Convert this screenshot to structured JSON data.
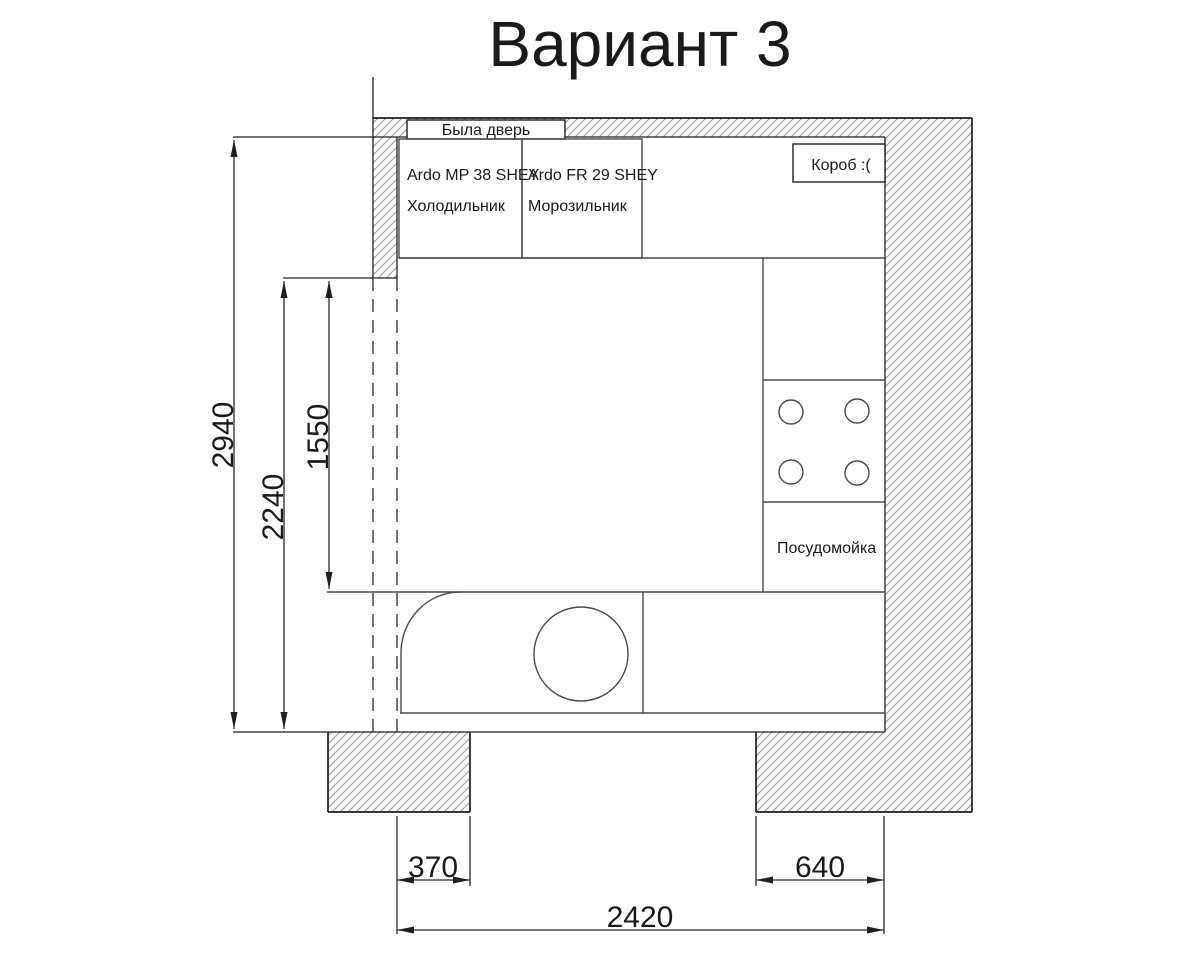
{
  "title": "Вариант 3",
  "plan": {
    "former_door_label": "Была дверь",
    "appliances": {
      "fridge_model": "Ardo MP 38 SHEY",
      "fridge_name": "Холодильник",
      "freezer_model": "Ardo FR 29 SHEY",
      "freezer_name": "Морозильник",
      "duct_label": "Короб :(",
      "dishwasher_label": "Посудомойка"
    },
    "dimensions_mm": {
      "room_depth": "2940",
      "opening_depth": "2240",
      "free_wall_length": "1550",
      "left_pier_width": "370",
      "right_pier_width": "640",
      "room_width": "2420"
    },
    "colors": {
      "background": "#ffffff",
      "main_line": "#1f1f1f",
      "furniture_line": "#4a4a4a",
      "wall_hatch": "#9e9e9e"
    }
  }
}
